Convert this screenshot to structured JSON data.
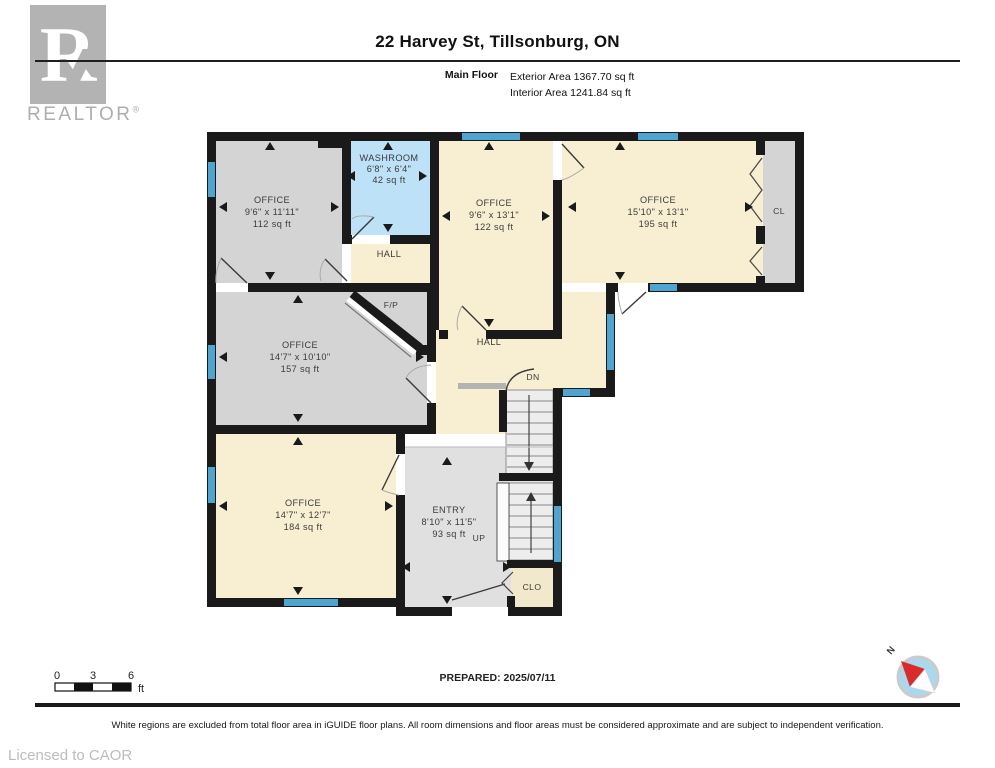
{
  "header": {
    "logo_letter": "R",
    "brand": "REALTOR",
    "registered": "®",
    "title": "22 Harvey St, Tillsonburg, ON",
    "floor_label": "Main Floor",
    "exterior_area": "Exterior Area 1367.70 sq ft",
    "interior_area": "Interior Area 1241.84 sq ft"
  },
  "plan": {
    "rooms": [
      {
        "id": "office-top-left",
        "name": "OFFICE",
        "dims": "9'6\" x 11'11\"",
        "area": "112 sq ft"
      },
      {
        "id": "washroom",
        "name": "WASHROOM",
        "dims": "6'8\" x 6'4\"",
        "area": "42 sq ft"
      },
      {
        "id": "hall-upper",
        "name": "HALL"
      },
      {
        "id": "office-top-middle",
        "name": "OFFICE",
        "dims": "9'6\" x 13'1\"",
        "area": "122 sq ft"
      },
      {
        "id": "office-top-right",
        "name": "OFFICE",
        "dims": "15'10\" x 13'1\"",
        "area": "195 sq ft"
      },
      {
        "id": "closet-cl",
        "name": "CL"
      },
      {
        "id": "fireplace",
        "name": "F/P"
      },
      {
        "id": "office-middle-left",
        "name": "OFFICE",
        "dims": "14'7\" x 10'10\"",
        "area": "157 sq ft"
      },
      {
        "id": "hall-main",
        "name": "HALL"
      },
      {
        "id": "stairs-down",
        "name": "DN"
      },
      {
        "id": "office-bottom-left",
        "name": "OFFICE",
        "dims": "14'7\" x 12'7\"",
        "area": "184 sq ft"
      },
      {
        "id": "entry",
        "name": "ENTRY",
        "dims": "8'10\" x 11'5\"",
        "area": "93 sq ft"
      },
      {
        "id": "stairs-up",
        "name": "UP"
      },
      {
        "id": "closet-clo",
        "name": "CLO"
      }
    ],
    "colors": {
      "wall": "#1a1a1a",
      "room_gray": "#d4d4d4",
      "room_cream": "#f8efd2",
      "washroom_blue": "#bde1f6",
      "entry_gray": "#e0e0e0",
      "window_blue": "#4fa5d2"
    }
  },
  "scale_bar": {
    "ticks": [
      "0",
      "3",
      "6"
    ],
    "unit": "ft"
  },
  "compass": {
    "label": "N"
  },
  "prepared_label": "PREPARED: 2025/07/11",
  "footer": {
    "disclaimer": "White regions are excluded from total floor area in iGUIDE floor plans. All room dimensions and floor areas must be considered approximate and are subject to independent verification.",
    "license": "Licensed to CAOR"
  }
}
